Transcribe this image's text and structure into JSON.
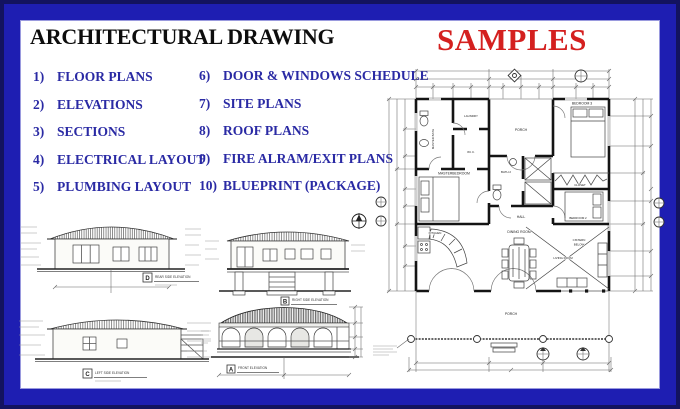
{
  "header": {
    "title": "ARCHITECTURAL DRAWING",
    "samples": "SAMPLES"
  },
  "services": {
    "column1": [
      {
        "num": "1)",
        "label": "FLOOR PLANS"
      },
      {
        "num": "2)",
        "label": "ELEVATIONS"
      },
      {
        "num": "3)",
        "label": "SECTIONS"
      },
      {
        "num": "4)",
        "label": "ELECTRICAL LAYOUT"
      },
      {
        "num": "5)",
        "label": "PLUMBING LAYOUT"
      }
    ],
    "column2": [
      {
        "num": "6)",
        "label": "DOOR & WINDOWS SCHEDULE"
      },
      {
        "num": "7)",
        "label": "SITE PLANS"
      },
      {
        "num": "8)",
        "label": "ROOF PLANS"
      },
      {
        "num": "9)",
        "label": "FIRE ALRAM/EXIT PLANS"
      },
      {
        "num": "10)",
        "label": "BLUEPRINT (PACKAGE)"
      }
    ]
  },
  "floor_plan": {
    "rooms": {
      "master_bath": "MASTER BATH",
      "laundry": "LAUNDRY",
      "wic": "W.I.C.",
      "porch_top": "PORCH",
      "bedroom3": "BEDROOM 3",
      "closet": "CLOSET",
      "master_bedroom": "MASTERBEDROOM",
      "bath2": "BATH 2",
      "hall": "HALL",
      "bedroom2": "BEDROOM 2",
      "kitchen": "KITCHEN",
      "dining": "DINING ROOM",
      "living": "LIVING ROOM",
      "cistern_1": "CISTERN",
      "cistern_2": "BELOW",
      "porch_bottom": "PORCH"
    }
  },
  "elevations": [
    {
      "tag": "D",
      "caption": "REAR SIDE ELEVATION"
    },
    {
      "tag": "B",
      "caption": "RIGHT SIDE ELEVATION"
    },
    {
      "tag": "C",
      "caption": "LEFT SIDE ELEVATION"
    },
    {
      "tag": "A",
      "caption": "FRONT ELEVATION"
    }
  ],
  "colors": {
    "border_blue": "#1e1eb2",
    "border_dark": "#13135f",
    "title_black": "#0d0d0d",
    "samples_red": "#d4201f",
    "list_blue": "#2a2aa4"
  }
}
